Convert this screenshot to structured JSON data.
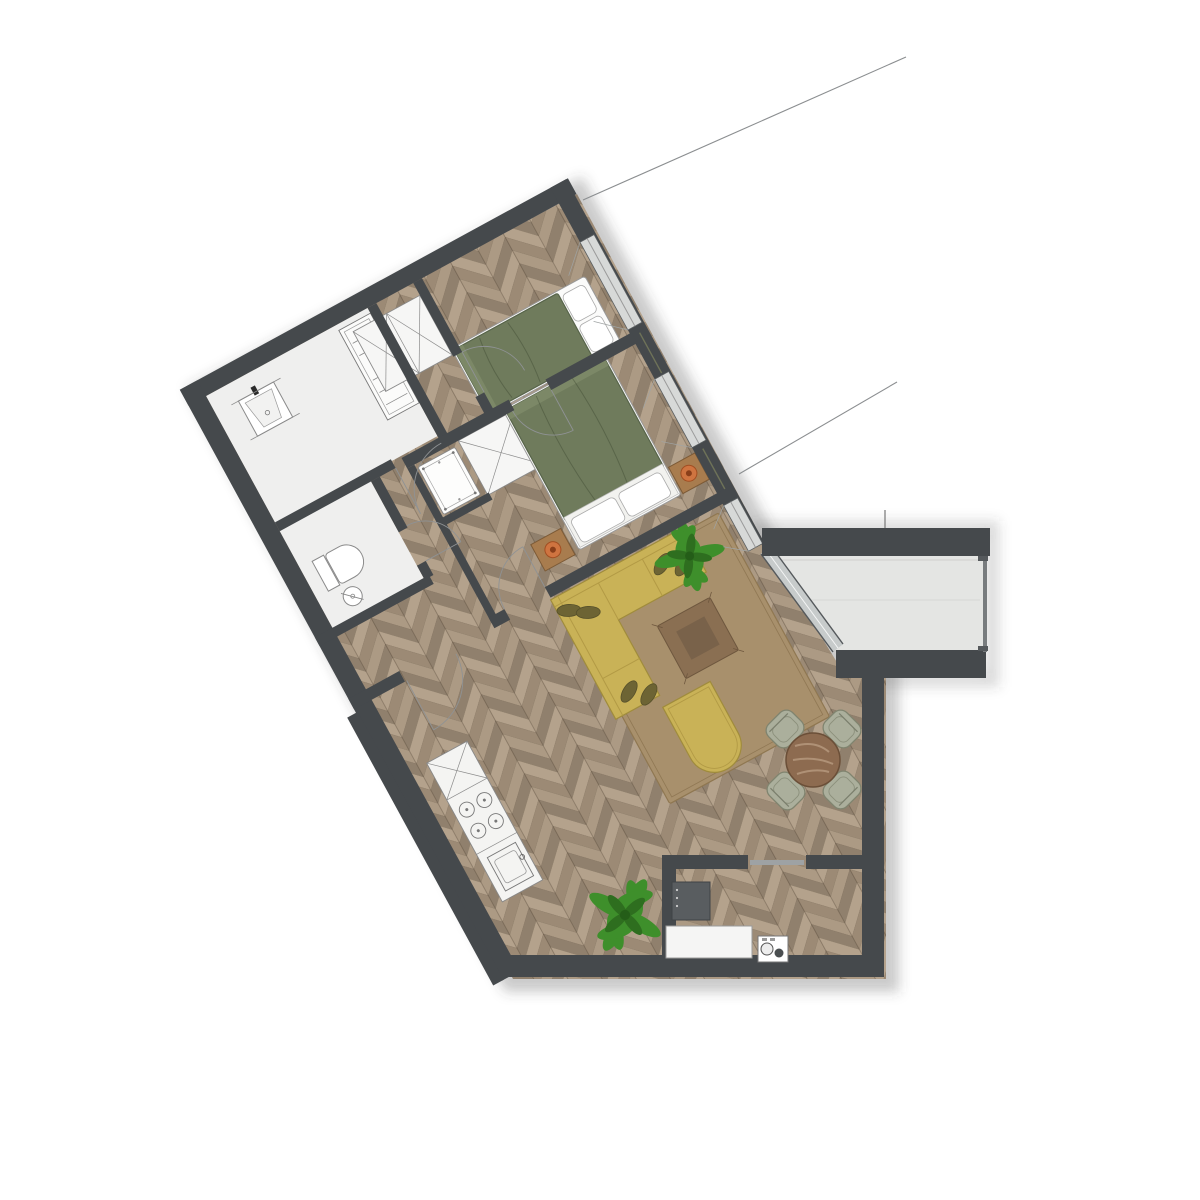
{
  "title": "apartment-floor-plan",
  "labels": {
    "bathtub_dimension": "2.25"
  },
  "semantics": [
    "bathroom",
    "wc",
    "hallway",
    "bedroom-1",
    "bedroom-2",
    "living-room",
    "kitchen",
    "balcony",
    "storage-room"
  ],
  "icons": [
    "sink-icon",
    "toilet-icon",
    "bathtub-icon",
    "wardrobe-x-icon",
    "crib-icon",
    "double-bed-icon",
    "single-bed-icon",
    "nightstand-lamp-icon",
    "corner-sofa-icon",
    "coffee-table-icon",
    "pouf-icon",
    "rug-icon",
    "dining-table-icon",
    "chair-icon",
    "stove-icon",
    "kitchen-sink-icon",
    "fridge-icon",
    "washing-machine-icon",
    "plant-icon",
    "window-icon",
    "door-swing-icon"
  ],
  "colors": {
    "wall": "#45494c",
    "wall_core": "#6e7258",
    "parquet_base": "#a3917d",
    "plank1": "#b4a28c",
    "plank2": "#9c8a75",
    "plank3": "#ac9a84",
    "plank4": "#90806d",
    "room_white": "#efefee",
    "balcony_floor": "#e4e5e3",
    "window_sill": "#d7d9d8",
    "glass": "#c7cbcb",
    "bed_green": "#6f7b5c",
    "bed_green_dark": "#57644a",
    "sofa_yellow": "#c9b257",
    "sofa_edge": "#a08c3c",
    "cushion_olive": "#6d6434",
    "rug_brown": "#a8906c",
    "rug_edge": "#8f7751",
    "table_brown": "#8a6f52",
    "table_inner": "#79624a",
    "dining_table": "#8d6b50",
    "chair_sage": "#abaf9c",
    "chair_edge": "#80846f",
    "wood_furniture": "#a87c4e",
    "lamp_orange": "#cf7440",
    "plant_green": "#3e8f2b",
    "plant_dark": "#2e6e1f",
    "fixture_line": "#8a8a8a",
    "white_fixture": "#f6f6f5",
    "appliance_dark": "#595d60",
    "leader": "#8b8e90"
  }
}
